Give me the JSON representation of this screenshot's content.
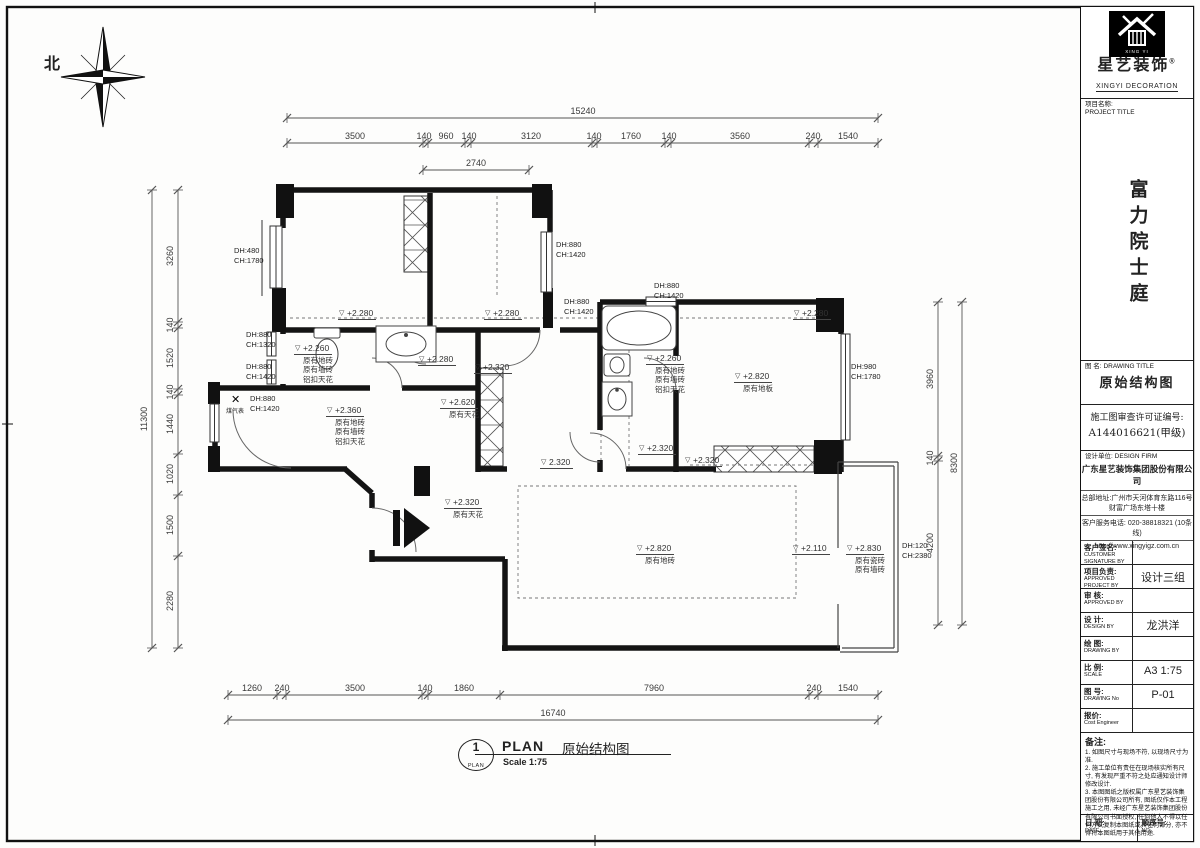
{
  "frame": {
    "north_label": "北"
  },
  "title_block": {
    "brand": {
      "logo_caption": "XING YI",
      "name_cn": "星艺装饰",
      "reg_mark": "®",
      "name_en": "XINGYI DECORATION"
    },
    "project": {
      "label_cn": "项目名称:",
      "label_en": "PROJECT TITLE",
      "name": "富力院士庭"
    },
    "drawing": {
      "label_cn": "图 名:",
      "label_en": "DRAWING TITLE",
      "title": "原始结构图"
    },
    "permit": {
      "line1": "施工图审查许可证编号:",
      "line2": "A144016621(甲级)"
    },
    "firm": {
      "label_cn": "设计单位:",
      "label_en": "DESIGN FIRM",
      "company": "广东星艺装饰集团股份有限公司",
      "address1": "总部地址:广州市天河体育东路116号",
      "address2": "财富广场东塔十楼",
      "phone": "客户服务电话: 020-38818321 (10条线)",
      "website": "http://www.xingyigz.com.cn"
    },
    "fields": [
      {
        "cn": "客户签名:",
        "en": "CUSTOMER SIGNATURE BY",
        "value": ""
      },
      {
        "cn": "项目负责:",
        "en": "APPROVED PROJECT BY",
        "value": "设计三组"
      },
      {
        "cn": "审 核:",
        "en": "APPROVED BY",
        "value": ""
      },
      {
        "cn": "设 计:",
        "en": "DESIGN BY",
        "value": "龙洪洋"
      },
      {
        "cn": "绘 图:",
        "en": "DRAWING BY",
        "value": ""
      },
      {
        "cn": "比 例:",
        "en": "SCALE",
        "value": "A3 1:75"
      },
      {
        "cn": "图 号:",
        "en": "DRAWING No",
        "value": "P-01"
      },
      {
        "cn": "报价:",
        "en": "Cost Engineer",
        "value": ""
      }
    ],
    "notes": {
      "label": "备注:",
      "items": [
        "1. 如图尺寸与现场不符, 以现场尺寸为准.",
        "2. 施工单位有责任在现场核实所有尺寸, 有发现严重不符之处应通知设计师修改设计.",
        "3. 本图图纸之版权属广东星艺装饰集团股份有限公司所有, 图纸仅作本工程施工之用, 未经广东星艺装饰集团股份有限公司书面授权, 任何他人不得以任何方式复制本图纸或其任何部分, 亦不得将本图纸用于其他用途."
      ]
    },
    "footer": {
      "date_cn": "日 期:",
      "date_en": "DATE",
      "no_cn": "顺序号:",
      "no_en": "NO."
    }
  },
  "plan_title": {
    "circle_num": "1",
    "circle_sub": "PLAN",
    "tag": "PLAN",
    "name": "原始结构图",
    "scale": "Scale 1:75"
  },
  "chains": [
    {
      "o": "h",
      "line": 118,
      "ticks": [
        287,
        878
      ],
      "labels": [
        {
          "t": "15240",
          "p": 583
        }
      ]
    },
    {
      "o": "h",
      "line": 143,
      "ticks": [
        287,
        423,
        428,
        465,
        471,
        592,
        597,
        665,
        671,
        809,
        818,
        878
      ],
      "labels": [
        {
          "t": "3500",
          "p": 355
        },
        {
          "t": "140",
          "p": 424
        },
        {
          "t": "960",
          "p": 446
        },
        {
          "t": "140",
          "p": 469
        },
        {
          "t": "3120",
          "p": 531
        },
        {
          "t": "140",
          "p": 594
        },
        {
          "t": "1760",
          "p": 631
        },
        {
          "t": "140",
          "p": 669
        },
        {
          "t": "3560",
          "p": 740
        },
        {
          "t": "240",
          "p": 813
        },
        {
          "t": "1540",
          "p": 848
        }
      ]
    },
    {
      "o": "h",
      "line": 170,
      "ticks": [
        423,
        529
      ],
      "labels": [
        {
          "t": "2740",
          "p": 476
        }
      ]
    },
    {
      "o": "h",
      "line": 695,
      "ticks": [
        228,
        277,
        286,
        422,
        428,
        500,
        809,
        818,
        878
      ],
      "labels": [
        {
          "t": "1260",
          "p": 252
        },
        {
          "t": "240",
          "p": 282
        },
        {
          "t": "3500",
          "p": 355
        },
        {
          "t": "140",
          "p": 425
        },
        {
          "t": "1860",
          "p": 464
        },
        {
          "t": "7960",
          "p": 654
        },
        {
          "t": "240",
          "p": 814
        },
        {
          "t": "1540",
          "p": 848
        }
      ]
    },
    {
      "o": "h",
      "line": 720,
      "ticks": [
        228,
        878
      ],
      "labels": [
        {
          "t": "16740",
          "p": 553
        }
      ]
    },
    {
      "o": "v",
      "line": 178,
      "ticks": [
        190,
        322,
        328,
        389,
        395,
        454,
        495,
        556,
        648
      ],
      "labels": [
        {
          "t": "3260",
          "p": 256
        },
        {
          "t": "140",
          "p": 325
        },
        {
          "t": "1520",
          "p": 358
        },
        {
          "t": "140",
          "p": 392
        },
        {
          "t": "1440",
          "p": 424
        },
        {
          "t": "1020",
          "p": 474
        },
        {
          "t": "1500",
          "p": 525
        },
        {
          "t": "2280",
          "p": 601
        }
      ]
    },
    {
      "o": "v",
      "line": 152,
      "ticks": [
        190,
        648
      ],
      "labels": [
        {
          "t": "11300",
          "p": 419
        }
      ]
    },
    {
      "o": "v",
      "line": 938,
      "ticks": [
        302,
        456,
        461,
        625
      ],
      "labels": [
        {
          "t": "3960",
          "p": 379
        },
        {
          "t": "140",
          "p": 458
        },
        {
          "t": "4200",
          "p": 543
        }
      ]
    },
    {
      "o": "v",
      "line": 962,
      "ticks": [
        302,
        625
      ],
      "labels": [
        {
          "t": "8300",
          "p": 463
        }
      ]
    }
  ],
  "levels": [
    {
      "v": "+2.280",
      "x": 338,
      "y": 303,
      "d": []
    },
    {
      "v": "+2.280",
      "x": 484,
      "y": 303,
      "d": []
    },
    {
      "v": "+2.280",
      "x": 793,
      "y": 303,
      "d": []
    },
    {
      "v": "+2.280",
      "x": 418,
      "y": 349,
      "d": []
    },
    {
      "v": "+2.260",
      "x": 294,
      "y": 338,
      "d": [
        "原有地砖",
        "原有墙砖",
        "铝扣天花"
      ]
    },
    {
      "v": "+2.360",
      "x": 326,
      "y": 400,
      "d": [
        "原有地砖",
        "原有墙砖",
        "铝扣天花"
      ]
    },
    {
      "v": "+2.620",
      "x": 440,
      "y": 392,
      "d": [
        "原有天花"
      ]
    },
    {
      "v": "+2.320",
      "x": 474,
      "y": 357,
      "d": []
    },
    {
      "v": "+2.260",
      "x": 646,
      "y": 348,
      "d": [
        "原有地砖",
        "原有墙砖",
        "铝扣天花"
      ]
    },
    {
      "v": "+2.320",
      "x": 638,
      "y": 438,
      "d": []
    },
    {
      "v": "2.320",
      "x": 540,
      "y": 452,
      "d": []
    },
    {
      "v": "+2.320",
      "x": 684,
      "y": 450,
      "d": []
    },
    {
      "v": "+2.820",
      "x": 734,
      "y": 366,
      "d": [
        "原有地板"
      ]
    },
    {
      "v": "+2.320",
      "x": 444,
      "y": 492,
      "d": [
        "原有天花"
      ]
    },
    {
      "v": "+2.820",
      "x": 636,
      "y": 538,
      "d": [
        "原有地砖"
      ]
    },
    {
      "v": "+2.110",
      "x": 792,
      "y": 538,
      "d": []
    },
    {
      "v": "+2.830",
      "x": 846,
      "y": 538,
      "d": [
        "原有瓷砖",
        "原有墙砖"
      ]
    }
  ],
  "openings": [
    {
      "l1": "DH:480",
      "l2": "CH:1780",
      "x": 234,
      "y": 246
    },
    {
      "l1": "DH:880",
      "l2": "CH:1320",
      "x": 246,
      "y": 330
    },
    {
      "l1": "DH:880",
      "l2": "CH:1420",
      "x": 246,
      "y": 362
    },
    {
      "l1": "DH:880",
      "l2": "CH:1420",
      "x": 250,
      "y": 394
    },
    {
      "l1": "DH:880",
      "l2": "CH:1420",
      "x": 556,
      "y": 240
    },
    {
      "l1": "DH:880",
      "l2": "CH:1420",
      "x": 654,
      "y": 281
    },
    {
      "l1": "DH:880",
      "l2": "CH:1420",
      "x": 564,
      "y": 297
    },
    {
      "l1": "DH:980",
      "l2": "CH:1780",
      "x": 851,
      "y": 362
    },
    {
      "l1": "DH:120",
      "l2": "CH:2380",
      "x": 902,
      "y": 541
    }
  ],
  "gas_meter": {
    "label": "煤气表"
  }
}
